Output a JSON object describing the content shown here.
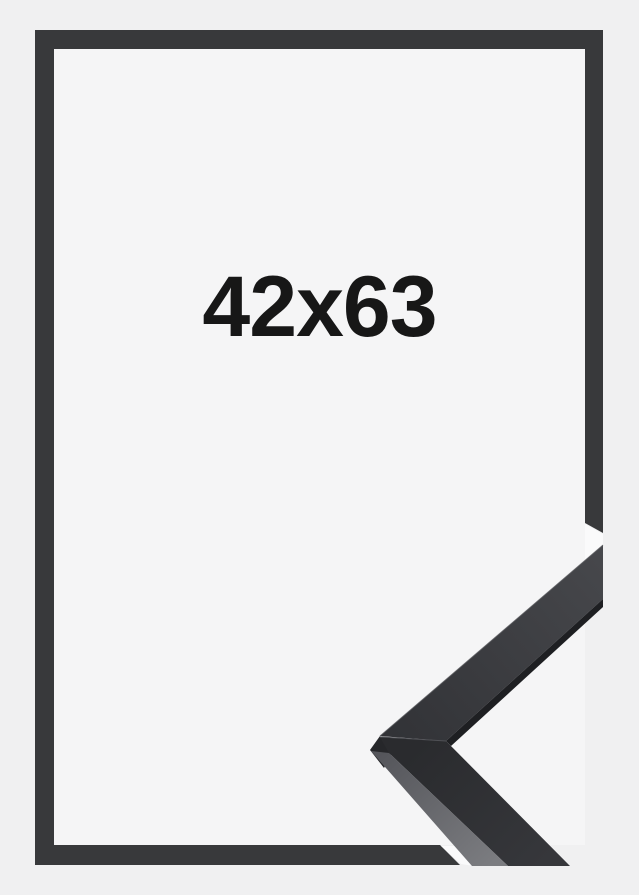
{
  "product_image": {
    "size_label": "42x63"
  },
  "colors": {
    "background_outer": "#f0f0f1",
    "background_inner": "#f5f5f6",
    "frame_outline": "#38393b",
    "closeup_face_light": "#47484c",
    "closeup_face_dark": "#2a2b2e",
    "closeup_side_light": "#7b7c80",
    "closeup_side_mid": "#55565b",
    "closeup_edge_dark": "#1e1f22",
    "closeup_cap": "#26272a",
    "photo_highlight": "#fafafb",
    "label_text": "#171717"
  }
}
